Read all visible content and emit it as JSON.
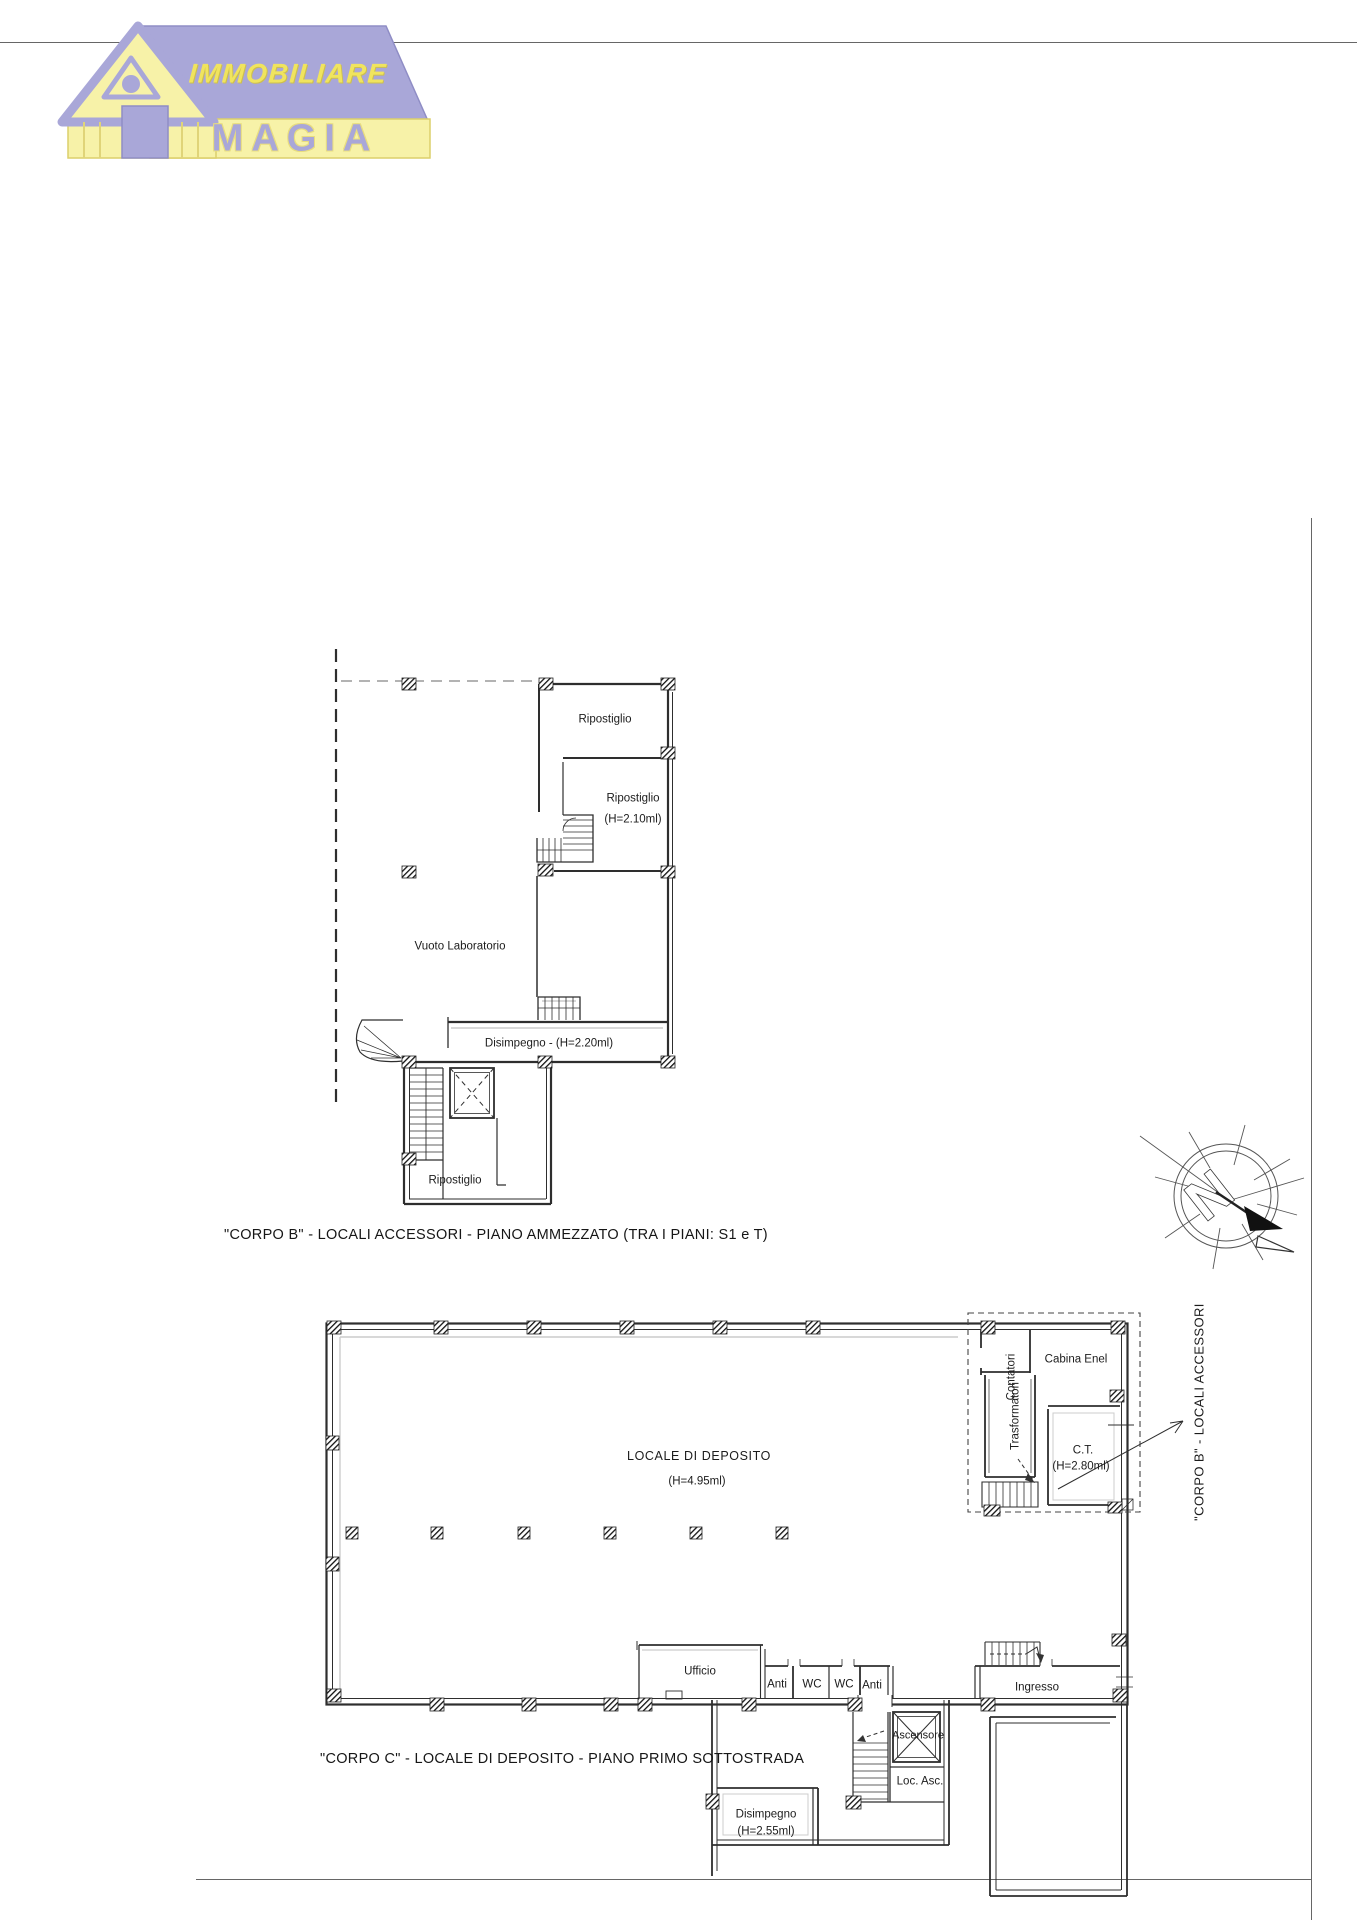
{
  "logo": {
    "line1": "IMMOBILIARE",
    "line2": "MAGIA"
  },
  "colors": {
    "logo_lavender": "#a9a7d8",
    "logo_pale_yellow": "#f7f2a8",
    "logo_golden_yellow": "#f0e45e",
    "drawing_line": "#2e2e2e"
  },
  "compass": {
    "letter": "N"
  },
  "plan_ammezzato": {
    "caption": "\"CORPO B\" - LOCALI ACCESSORI - PIANO AMMEZZATO (TRA I PIANI: S1 e T)",
    "rooms": {
      "ripostiglio_top": "Ripostiglio",
      "ripostiglio_mid": "Ripostiglio",
      "ripostiglio_mid_height": "(H=2.10ml)",
      "vuoto_laboratorio": "Vuoto Laboratorio",
      "disimpegno": "Disimpegno - (H=2.20ml)",
      "ripostiglio_bottom": "Ripostiglio"
    }
  },
  "plan_sottostrada": {
    "caption": "\"CORPO C\" - LOCALE DI DEPOSITO - PIANO PRIMO SOTTOSTRADA",
    "side_label": "\"CORPO B\" - LOCALI ACCESSORI",
    "rooms": {
      "locale": "LOCALE DI DEPOSITO",
      "locale_height": "(H=4.95ml)",
      "contatori": "Contatori",
      "cabina_enel": "Cabina Enel",
      "trasformatori": "Trasformatori",
      "ct": "C.T.",
      "ct_height": "(H=2.80ml)",
      "ufficio": "Ufficio",
      "anti_left": "Anti",
      "wc_left": "WC",
      "wc_right": "WC",
      "anti_right": "Anti",
      "ingresso": "Ingresso",
      "ascensore": "Ascensore",
      "loc_asc": "Loc. Asc.",
      "disimpegno": "Disimpegno",
      "disimpegno_height": "(H=2.55ml)"
    }
  }
}
